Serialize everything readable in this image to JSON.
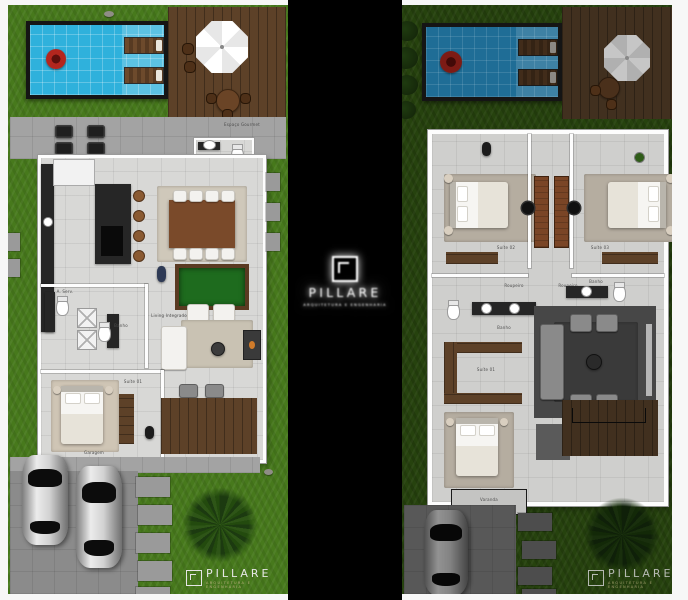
{
  "watermark": {
    "brand": "PILLARE",
    "tagline": "ARQUITETURA E ENGENHARIA"
  },
  "footer_logo_left": {
    "brand": "PILLARE",
    "tagline": "ARQUITETURA E ENGENHARIA"
  },
  "footer_logo_right": {
    "brand": "PILLARE",
    "tagline": "ARQUITETURA E ENGENHARIA"
  },
  "left_plan": {
    "name": "Pavimento Térreo",
    "labels": {
      "espaco_gourmet": "Espaço Gourmet",
      "lavabo": "Lavabo",
      "aserv": "A. Serv.",
      "banho": "Banho",
      "living": "Living Integrado",
      "suite01": "Suíte 01",
      "garagem": "Garagem"
    }
  },
  "right_plan": {
    "name": "Pavimento Superior",
    "labels": {
      "suite02": "Suíte 02",
      "suite03": "Suíte 03",
      "roupeiro_l": "Roupeiro",
      "roupeiro_r": "Roupeiro",
      "banho_l": "Banho",
      "banho_r": "Banho",
      "circ": "Circ.",
      "closet_suite": "Suíte 01",
      "varanda": "Varanda"
    }
  },
  "palette": {
    "grass_light": "#47791c",
    "grass_shaded": "#26420e",
    "pool_water": "#2fb1dc",
    "pool_water_shaded": "#1f6d96",
    "deck_wood": "#5d4128",
    "float_red": "#b3261e",
    "floor_tile": "#d8d8d6",
    "backdrop": "#000000"
  }
}
